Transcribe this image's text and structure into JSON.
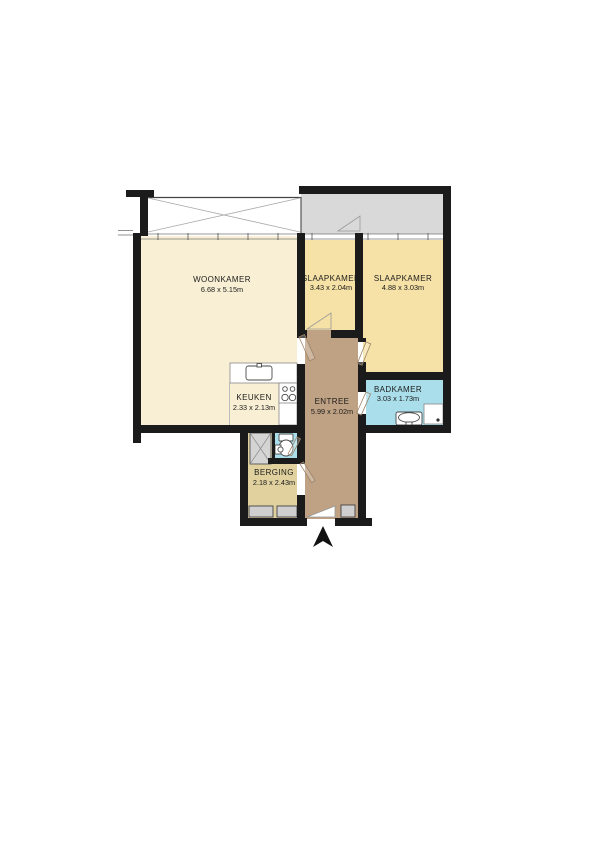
{
  "plan": {
    "type": "apartment-floorplan",
    "rooms": [
      {
        "id": "woonkamer",
        "name": "WOONKAMER",
        "dims": "6.68 x 5.15m"
      },
      {
        "id": "slaapkamer-1",
        "name": "SLAAPKAMER",
        "dims": "3.43 x 2.04m"
      },
      {
        "id": "slaapkamer-2",
        "name": "SLAAPKAMER",
        "dims": "4.88 x 3.03m"
      },
      {
        "id": "keuken",
        "name": "KEUKEN",
        "dims": "2.33 x 2.13m"
      },
      {
        "id": "entree",
        "name": "ENTREE",
        "dims": "5.99 x 2.02m"
      },
      {
        "id": "badkamer",
        "name": "BADKAMER",
        "dims": "3.03 x 1.73m"
      },
      {
        "id": "berging",
        "name": "BERGING",
        "dims": "2.18 x 2.43m"
      }
    ],
    "colors": {
      "wall": "#1b1b1b",
      "woonkamer": "#f8efd4",
      "slaapkamer": "#f6e2a6",
      "entree": "#bfa183",
      "badkamer": "#aadeea",
      "toilet": "#aadeea",
      "berging": "#e0d19e",
      "balcony": "#d9d9d9",
      "closet": "#d4d4d4"
    },
    "fixtures": [
      "kitchen-sink",
      "stove",
      "toilet",
      "corner-basin",
      "washbasin",
      "shower",
      "storage-lockers",
      "closet",
      "north-arrow"
    ]
  }
}
